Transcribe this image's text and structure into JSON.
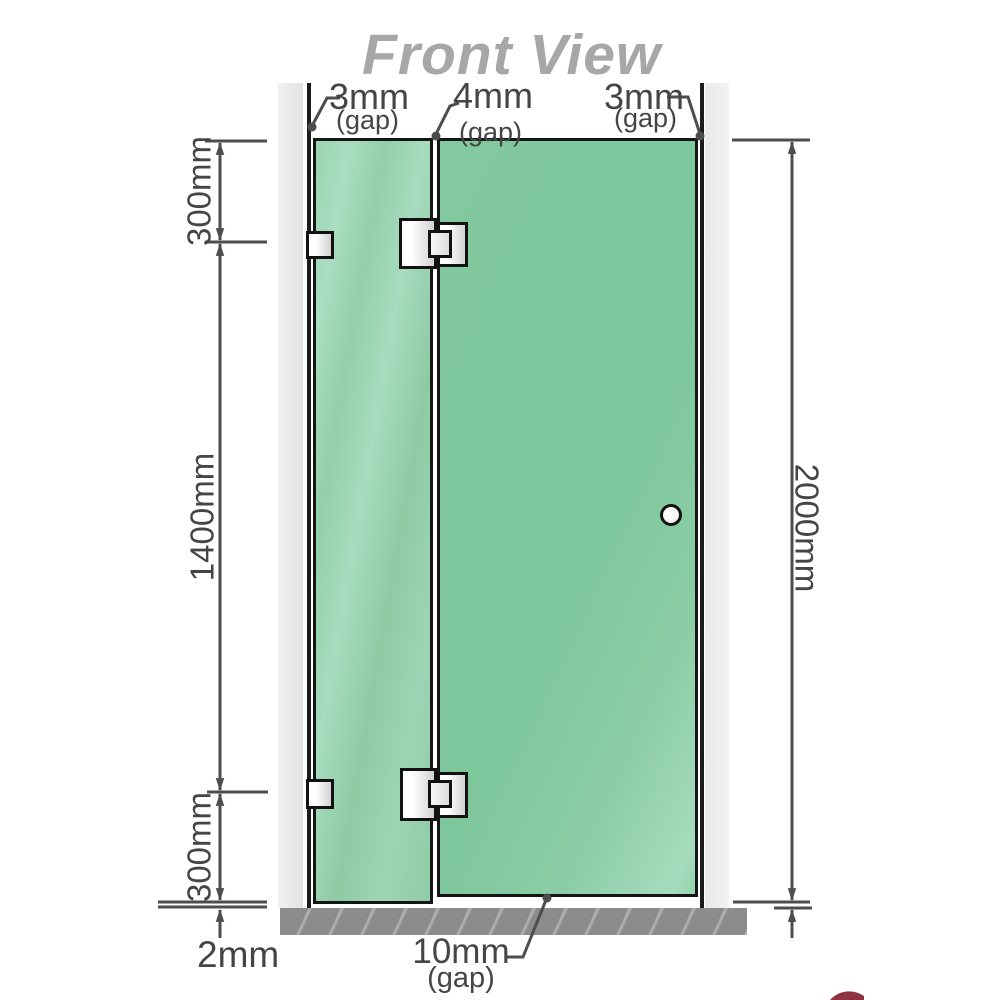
{
  "title": "Front View",
  "annotations": {
    "top_gaps": [
      {
        "value": "3mm",
        "unit": "(gap)"
      },
      {
        "value": "4mm",
        "unit": "(gap)"
      },
      {
        "value": "3mm",
        "unit": "(gap)"
      }
    ],
    "left": {
      "top_segment": "300mm",
      "middle_segment": "1400mm",
      "bottom_segment": "300mm",
      "floor_gap": "2mm"
    },
    "right": {
      "total_height": "2000mm"
    },
    "bottom": {
      "door_floor_gap_value": "10mm",
      "door_floor_gap_unit": "(gap)"
    }
  },
  "colors": {
    "glass_green": "#8ecba6",
    "wall_gray": "#e9e9e9",
    "base_gray": "#8c8c8c",
    "dimension_line": "#4d4d4d",
    "label_text": "#454545",
    "title_gray": "#a7a7a7",
    "corner_mark_red": "#7d0f1e"
  }
}
